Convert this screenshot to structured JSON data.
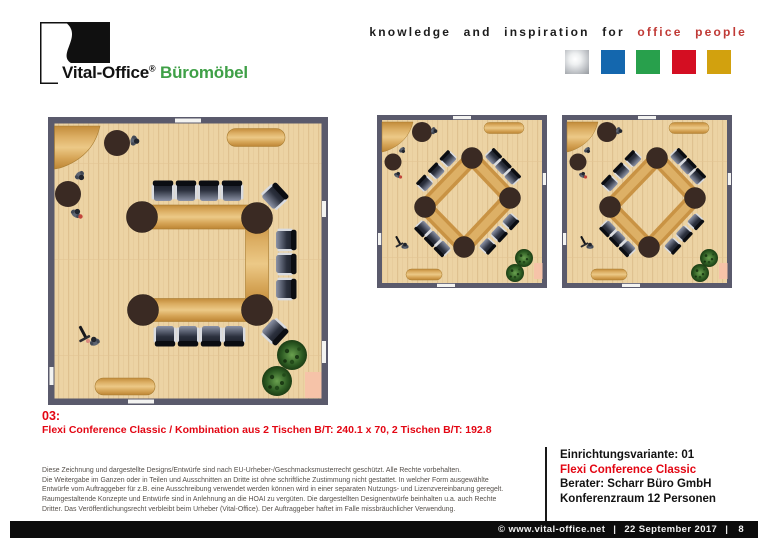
{
  "colors": {
    "accent_red": "#e30613",
    "tagline_red": "#c03a36",
    "logo_green": "#3fa047",
    "wall": "#5a5a6c",
    "floor": "#ecd3a4",
    "wood": "#d6a85c",
    "round_table": "#3a2a23"
  },
  "header": {
    "logo": {
      "brand": "Vital-Office",
      "registered": "®",
      "product": "Büromöbel"
    },
    "tagline": {
      "prefix": "knowledge and inspiration for",
      "highlight": "office people"
    },
    "squares": [
      {
        "name": "silver",
        "color": "#b9bcc0"
      },
      {
        "name": "blue",
        "color": "#1467ae"
      },
      {
        "name": "green",
        "color": "#28a04c"
      },
      {
        "name": "red",
        "color": "#d40e22"
      },
      {
        "name": "gold",
        "color": "#d2a10e"
      }
    ]
  },
  "caption": {
    "number": "03:",
    "description": "Flexi Conference Classic / Kombination aus 2 Tischen B/T: 240.1 x 70, 2 Tischen B/T: 192.8"
  },
  "legal": {
    "lines": [
      "Diese Zeichnung und dargestellte Designs/Entwürfe sind nach EU-Urheber-/Geschmacksmusterrecht geschützt. Alle Rechte vorbehalten.",
      "Die Weitergabe im Ganzen oder in Teilen und Ausschnitten an Dritte ist ohne schriftliche Zustimmung nicht gestattet. In welcher Form ausgewählte",
      "Entwürfe vom Auftraggeber für z.B. eine Ausschreibung verwendet werden können wird in einer separaten Nutzungs- und Lizenzvereinbarung geregelt.",
      "Raumgestaltende Konzepte und Entwürfe sind in Anlehnung an die HOAI zu vergüten. Die dargestellten Designentwürfe beinhalten u.a. auch Rechte",
      "Dritter. Das Veröffentlichungsrecht verbleibt beim Urheber (Vital-Office). Der Auftraggeber haftet im Falle missbräuchlicher Verwendung."
    ]
  },
  "info_panel": {
    "variant": "Einrichtungsvariante: 01",
    "product": "Flexi Conference Classic",
    "consultant": "Berater: Scharr Büro GmbH",
    "room": "Konferenzraum 12 Personen"
  },
  "footer": {
    "copyright": "© www.vital-office.net",
    "separator": "|",
    "date": "22 September 2017",
    "page": "8"
  }
}
